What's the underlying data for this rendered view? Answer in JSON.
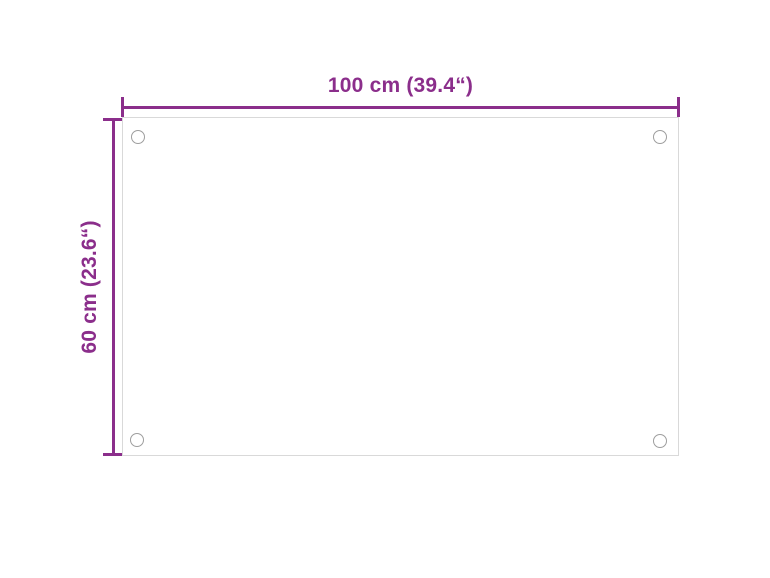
{
  "diagram": {
    "title": "product-dimension-diagram",
    "panel": {
      "shape": "rectangle",
      "hole_count": 4
    },
    "dimensions": {
      "width": {
        "label": "100 cm (39.4“)"
      },
      "height": {
        "label": "60 cm (23.6“)"
      }
    },
    "colors": {
      "dimension": "#8b2e8b",
      "panel_border": "#d9d9d9",
      "hole_stroke": "#9e9e9e",
      "background": "#ffffff"
    }
  }
}
